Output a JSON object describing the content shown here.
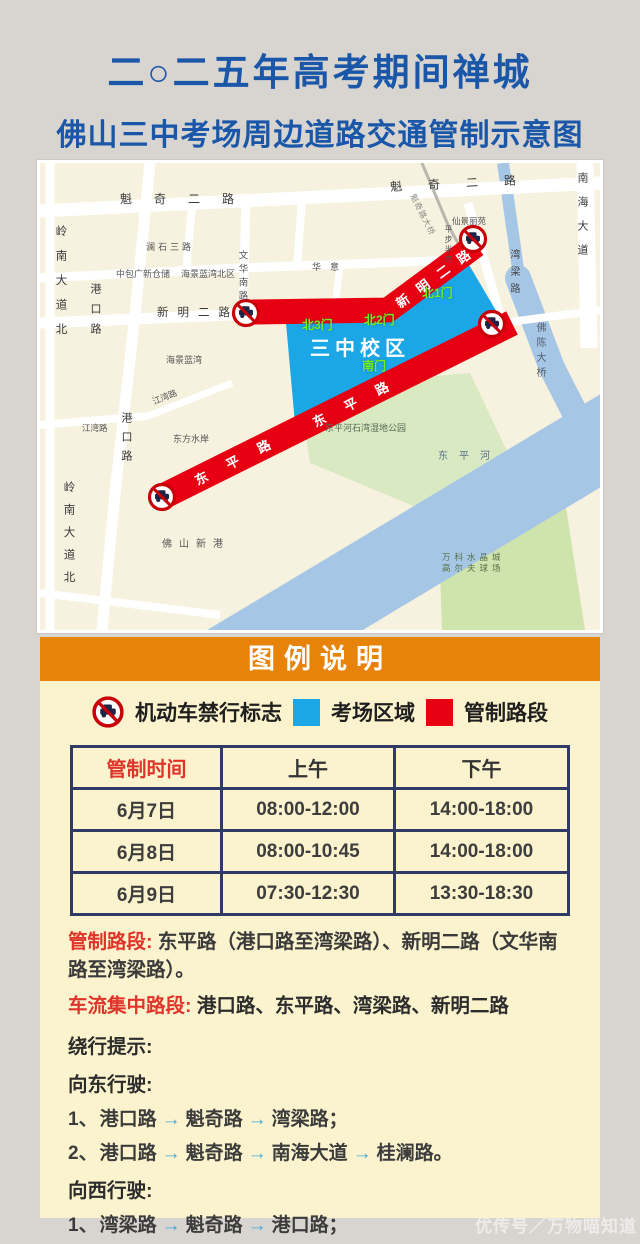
{
  "title": {
    "line1": "二○二五年高考期间禅城",
    "line2": "佛山三中考场周边道路交通管制示意图"
  },
  "map": {
    "labels": {
      "kuiqi_left": "魁奇二路",
      "kuiqi_right": "魁奇二路",
      "lanshi_san_lu": "澜石三路",
      "zhongbao_warehouse": "中包广新仓储",
      "haijing_lanwan_beiqu": "海景蓝湾北区",
      "haijing_lanwan": "海景蓝湾",
      "wenhua_nan_lu": "文华南路",
      "huayi": "华意",
      "xinming_er_lu": "新明二路",
      "xinming_band": "新明二路",
      "gangkou_lu_n": "港口路",
      "gangkou_lu_s": "港口路",
      "lingnan_n": "岭南大道北",
      "lingnan_s": "岭南大道北",
      "jiangwan_1": "江湾路",
      "jiangwan_2": "江湾路",
      "dongfang_shui_an": "东方水岸",
      "foshan_xingang": "佛山新港",
      "wetland_park": "东平河石湾湿地公园",
      "dongping_he": "东平河",
      "vanke_1": "万科水晶城",
      "vanke_2": "高尔夫球场",
      "wanliang_lu": "湾梁路",
      "nanhai_dadao": "南海大道",
      "fochen_daqiao": "佛陈大桥",
      "xianjing_liyuan": "仙景丽苑",
      "pingbu_bandao": "平步半岛",
      "kuiqi_bridge": "魁奇路大桥",
      "campus": "三中校区",
      "gate_n1": "北1门",
      "gate_n2": "北2门",
      "gate_n3": "北3门",
      "gate_s": "南门",
      "dongping_band": "东平路"
    }
  },
  "legend": {
    "header": "图例说明",
    "no_entry_label": "机动车禁行标志",
    "exam_area_label": "考场区域",
    "control_section_label": "管制路段"
  },
  "schedule": {
    "headers": [
      "管制时间",
      "上午",
      "下午"
    ],
    "rows": [
      [
        "6月7日",
        "08:00-12:00",
        "14:00-18:00"
      ],
      [
        "6月8日",
        "08:00-10:45",
        "14:00-18:00"
      ],
      [
        "6月9日",
        "07:30-12:30",
        "13:30-18:30"
      ]
    ]
  },
  "notes": {
    "control_label": "管制路段:",
    "control_text": "东平路（港口路至湾梁路）、新明二路（文华南路至湾梁路）。",
    "congestion_label": "车流集中路段:",
    "congestion_text": "港口路、东平路、湾梁路、新明二路",
    "detour_label": "绕行提示:",
    "east_label": "向东行驶:",
    "west_label": "向西行驶:"
  },
  "routes": {
    "east": [
      {
        "no": "1、",
        "roads": [
          "港口路",
          "魁奇路",
          "湾梁路；"
        ]
      },
      {
        "no": "2、",
        "roads": [
          "港口路",
          "魁奇路",
          "南海大道",
          "桂澜路。"
        ]
      }
    ],
    "west": [
      {
        "no": "1、",
        "roads": [
          "湾梁路",
          "魁奇路",
          "港口路；"
        ]
      },
      {
        "no": "2、",
        "roads": [
          "桂澜路",
          "魁奇路",
          "岭南大道",
          "东平路。"
        ]
      }
    ]
  },
  "glyphs": {
    "arrow": "→"
  },
  "watermark": "优传号／万物喵知道",
  "colors": {
    "title_blue": "#1a57a8",
    "accent_orange": "#e8830a",
    "exam_area_blue": "#1ba6e6",
    "control_red": "#e60012",
    "red_text": "#e0342b",
    "arrow_blue": "#3da8dc",
    "table_border_navy": "#2f3b66",
    "panel_yellow": "#fbf3cd"
  }
}
